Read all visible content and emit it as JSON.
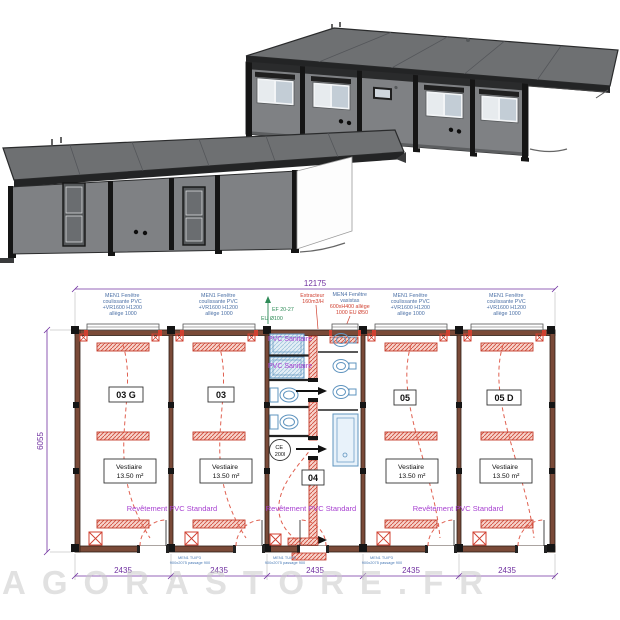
{
  "watermark": "AGORASTORE.FR",
  "plan": {
    "dim_total": "12175",
    "dim_height": "6055",
    "module_dims": [
      "2435",
      "2435",
      "2435",
      "2435",
      "2435"
    ],
    "room_labels": [
      "03 G",
      "03",
      "04",
      "05",
      "05 D"
    ],
    "vestiaire": {
      "name": "Vestiaire",
      "area": "13.50 m²"
    },
    "pvc_sanitaire": "PVC Sanitaire",
    "revetement": "Revêtement PVC Standard",
    "water_heater": {
      "line1": "CE",
      "line2": "200l"
    },
    "door_label": {
      "line1": "MEN1 TU/P3",
      "line2": "900x2075 passage 900"
    }
  },
  "annotations": {
    "men1_window": [
      "MEN1 Fenêtre",
      "coulissante PVC",
      "+VR1600 H1200",
      "allège 1000"
    ],
    "extracteur": [
      "Extracteur",
      "160m3/H"
    ],
    "ef": "EF 20-27",
    "eu100": "EU Ø100",
    "men4_window": [
      "MEN4 Fenêtre",
      "vasistas",
      "600xH400 allège",
      "1000 EU Ø50"
    ]
  },
  "colors": {
    "wall_brown": "#7a4a38",
    "fixture_red": "#d04030",
    "text_purple": "#a73fd0",
    "dim_purple": "#7030a0",
    "fixture_blue": "#5f94bf",
    "annotation_blue": "#4a6fa5",
    "note_green": "#2e8b57",
    "building_gray": "#7f8184"
  }
}
